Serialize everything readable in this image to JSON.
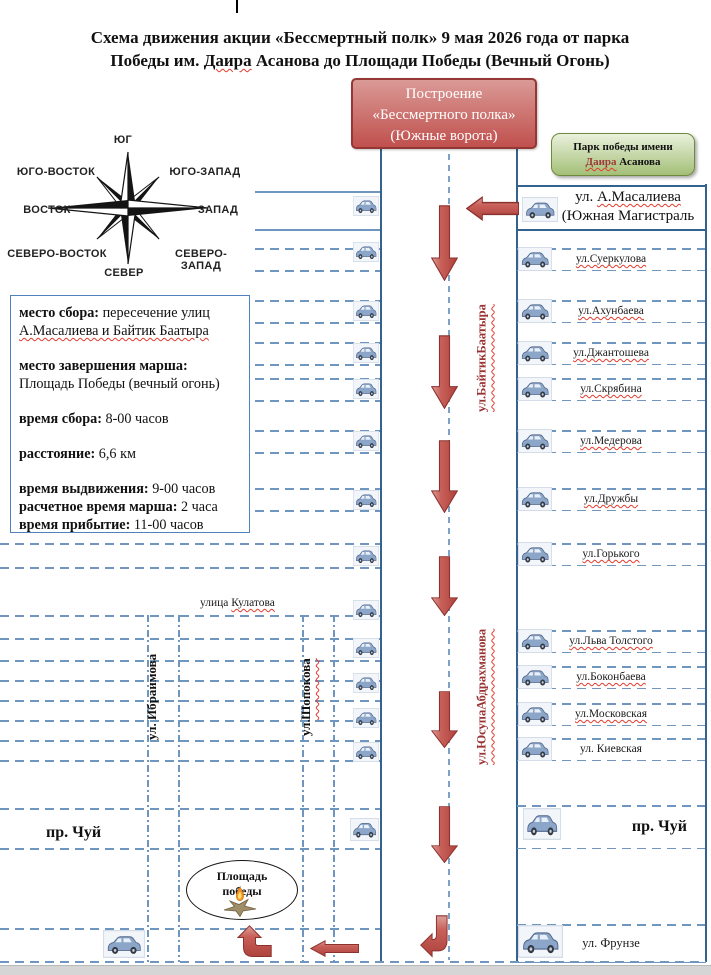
{
  "title": {
    "line1": "Схема движения акции «Бессмертный полк» 9 мая 2026 года от парка",
    "line2_pre": "Победы им. ",
    "line2_name": "Даира",
    "line2_post": " Асанова до Площади Победы (Вечный Огонь)"
  },
  "compass": {
    "top": "ЮГ",
    "top_left": "ЮГО-ВОСТОК",
    "top_right": "ЮГО-ЗАПАД",
    "left": "ВОСТОК",
    "right": "ЗАПАД",
    "bottom_left": "СЕВЕРО-ВОСТОК",
    "bottom_right": "СЕВЕРО-ЗАПАД",
    "bottom": "СЕВЕР"
  },
  "start_box": {
    "line1": "Построение",
    "line2": "«Бессмертного полка»",
    "line3": "(Южные ворота)"
  },
  "park_box": {
    "line1": "Парк победы имени",
    "name": "Даира",
    "name_rest": " Асанова"
  },
  "info_box": {
    "p1_label": "место сбора:",
    "p1_text": " пересечение улиц ",
    "p1_streets": "А.Масалиева и Байтик Баатыра",
    "p2_label": "место завершения марша:",
    "p2_text": "Площадь Победы (вечный огонь)",
    "p3_label": "время сбора:",
    "p3_text": " 8-00 часов",
    "p4_label": "расстояние:",
    "p4_text": " 6,6 км",
    "p5_label": "время выдвижения:",
    "p5_text": " 9-00 часов",
    "p6_label": "расчетное время марша:",
    "p6_text": " 2 часа",
    "p7_label": "время прибытие:",
    "p7_text": " 11-00 часов"
  },
  "streets": {
    "masalieva_pre": "ул. ",
    "masalieva_name": "А.Масалиева",
    "masalieva_line2": "(Южная Магистраль",
    "right": [
      "ул.Суеркулова",
      "ул.Ахунбаева",
      "ул.Джантошева",
      "ул.Скрябина",
      "ул.Медерова",
      "ул.Дружбы",
      "ул.Горького",
      "ул.Льва Толстого",
      "ул.Боконбаева",
      "ул.Московская",
      "ул. Киевская"
    ],
    "chuy_right": "пр. Чуй",
    "frunze": "ул. Фрунзе",
    "chuy_left": "пр. Чуй",
    "kulatova_pre": "улица ",
    "kulatova_name": "Кулатова",
    "baytik": "ул.БайтикБаатыра",
    "yusup": "ул.ЮсупаАбдрахманова",
    "ibraimova": "ул. Ибраимова",
    "shopokova_pre": "ул.",
    "shopokova_name": "Шопокова"
  },
  "victory_square": {
    "line1": "Площадь",
    "line2": "победы"
  },
  "colors": {
    "accent_red": "#C0504D",
    "park_green": "#A3BF77",
    "line_blue": "#35618E",
    "dash_blue": "#6E96BE",
    "spell_red": "#E23B2E",
    "street_red": "#993333"
  }
}
